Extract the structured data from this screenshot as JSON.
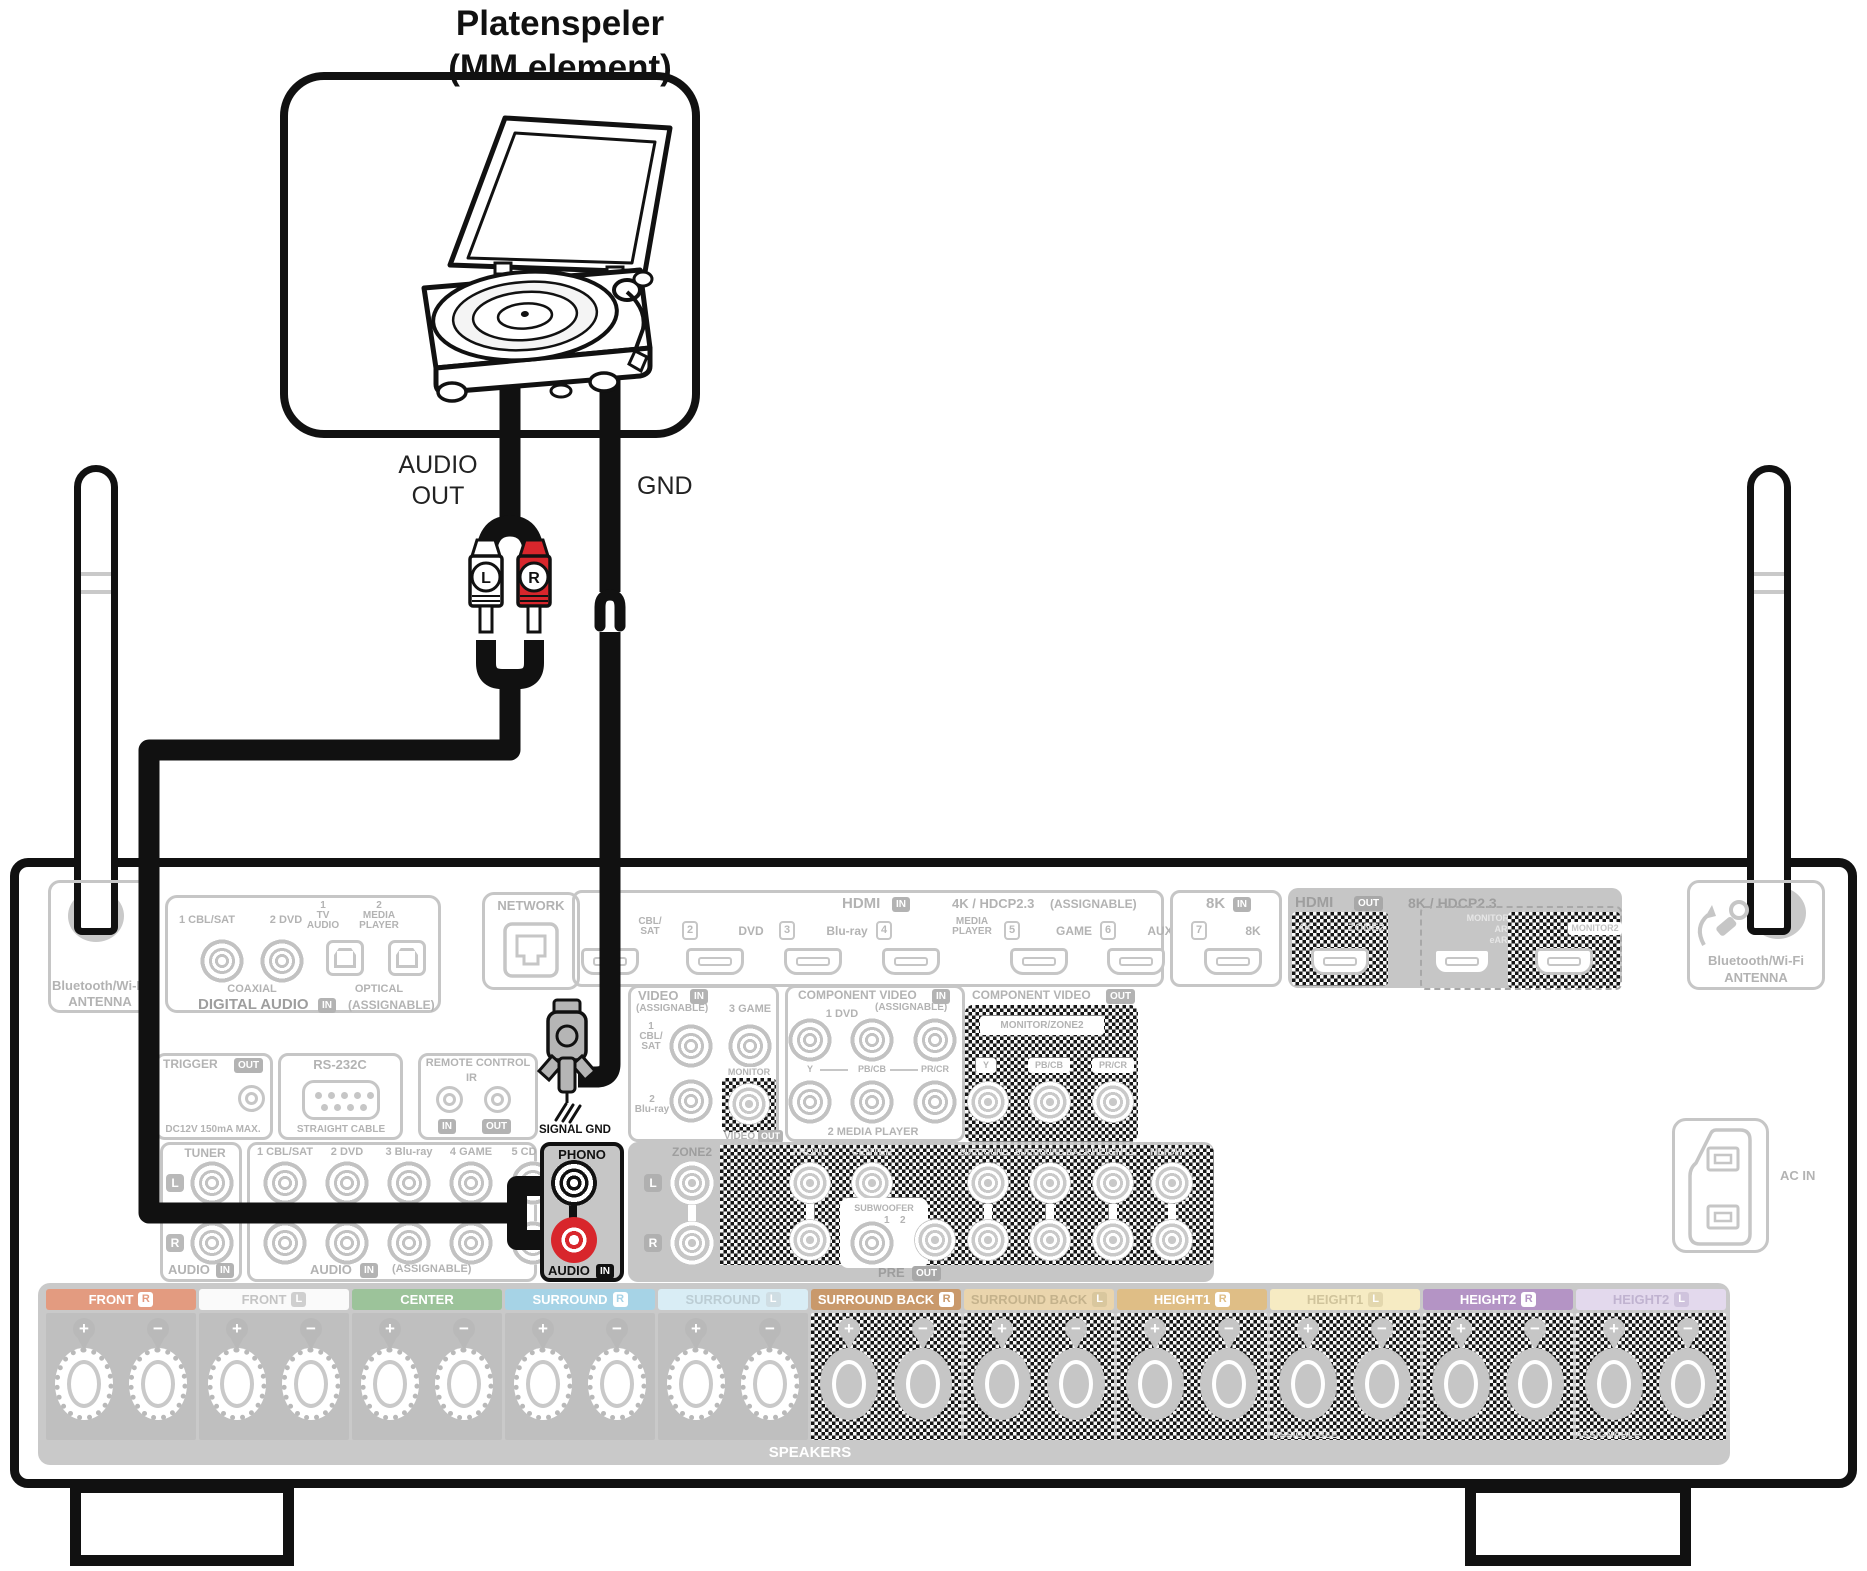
{
  "title": {
    "line1": "Platenspeler",
    "line2": "(MM element)"
  },
  "cables": {
    "audio_out": "AUDIO\nOUT",
    "gnd": "GND",
    "plug_l": "L",
    "plug_r": "R"
  },
  "colors": {
    "accent_red_plug": "#d8262c",
    "hatch_black": "#161616",
    "panel_gray": "#c6c6c6"
  },
  "panel": {
    "bt_left": {
      "line1": "Bluetooth/Wi-Fi",
      "line2": "ANTENNA"
    },
    "bt_right": {
      "line1": "Bluetooth/Wi-Fi",
      "line2": "ANTENNA"
    },
    "digital_audio": {
      "coax1": "1 CBL/SAT",
      "coax2": "2 DVD",
      "opt1": "1\nTV\nAUDIO",
      "opt2": "2\nMEDIA\nPLAYER",
      "coaxial": "COAXIAL",
      "optical": "OPTICAL",
      "title": "DIGITAL AUDIO",
      "badge_in": "IN",
      "assignable": "(ASSIGNABLE)"
    },
    "network": {
      "title": "NETWORK"
    },
    "hdmi_in": {
      "title": "HDMI",
      "badge_in": "IN",
      "spec": "4K / HDCP2.3",
      "assignable": "(ASSIGNABLE)",
      "p1": "CBL/\nSAT",
      "n2": "2",
      "p2": "DVD",
      "n3": "3",
      "p3": "Blu-ray",
      "n4": "4",
      "p4": "MEDIA\nPLAYER",
      "n5": "5",
      "p5": "GAME",
      "n6": "6",
      "p6": "AUX",
      "eightk_title": "8K",
      "eightk_badge": "IN",
      "n7": "7",
      "p7": "8K"
    },
    "hdmi_out": {
      "title": "HDMI",
      "badge_out": "OUT",
      "spec": "8K / HDCP2.3",
      "zone_4k": "4K",
      "zone2": "ZONE2",
      "monitor1": "MONITOR1\nARC\neARC",
      "monitor2": "MONITOR2"
    },
    "video_in": {
      "title": "VIDEO",
      "badge_in": "IN",
      "assignable": "(ASSIGNABLE)",
      "game": "3 GAME",
      "cblsat": "1\nCBL/\nSAT",
      "bluray": "2\nBlu-ray",
      "monitor": "MONITOR",
      "vout_title": "VIDEO",
      "vout_badge": "OUT"
    },
    "comp_in": {
      "title": "COMPONENT VIDEO",
      "badge_in": "IN",
      "assignable": "(ASSIGNABLE)",
      "dvd": "1 DVD",
      "y": "Y",
      "pb": "PB/CB",
      "pr": "PR/CR",
      "media": "2 MEDIA PLAYER"
    },
    "comp_out": {
      "title": "COMPONENT VIDEO",
      "badge_out": "OUT",
      "monitor": "MONITOR/ZONE2",
      "y": "Y",
      "pb": "PB/CB",
      "pr": "PR/CR"
    },
    "trigger": {
      "title": "TRIGGER",
      "badge_out": "OUT",
      "spec": "DC12V 150mA MAX."
    },
    "rs232": {
      "title": "RS-232C",
      "spec": "STRAIGHT CABLE"
    },
    "remote": {
      "title": "REMOTE CONTROL",
      "ir": "IR",
      "badge_in": "IN",
      "badge_out": "OUT"
    },
    "signal_gnd": "SIGNAL GND",
    "phono": {
      "title": "PHONO",
      "audio": "AUDIO",
      "badge_in": "IN"
    },
    "tuner": {
      "title": "TUNER",
      "l": "L",
      "r": "R",
      "audio": "AUDIO",
      "badge_in": "IN"
    },
    "analog": {
      "c1": "1 CBL/SAT",
      "c2": "2 DVD",
      "c3": "3 Blu-ray",
      "c4": "4 GAME",
      "c5": "5 CD",
      "audio": "AUDIO",
      "badge_in": "IN",
      "assignable": "(ASSIGNABLE)"
    },
    "pre_out": {
      "zone2": "ZONE2",
      "l": "L",
      "r": "R",
      "front": "FRONT",
      "center": "CENTER",
      "surround": "SURROUND",
      "surround_back": "SURROUND BACK",
      "height1": "HEIGHT1",
      "height2": "HEIGHT2",
      "subwoofer": "SUBWOOFER",
      "sub1": "1",
      "sub2": "2",
      "pre": "PRE",
      "badge_out": "OUT"
    },
    "ac_in": "AC IN"
  },
  "speakers": {
    "plus": "+",
    "minus": "−",
    "strip": "SPEAKERS",
    "assignable": "ASSIGNABLE",
    "sections": [
      {
        "label": "FRONT",
        "ch": "R"
      },
      {
        "label": "FRONT",
        "ch": "L"
      },
      {
        "label": "CENTER",
        "ch": ""
      },
      {
        "label": "SURROUND",
        "ch": "R"
      },
      {
        "label": "SURROUND",
        "ch": "L"
      },
      {
        "label": "SURROUND BACK",
        "ch": "R"
      },
      {
        "label": "SURROUND BACK",
        "ch": "L"
      },
      {
        "label": "HEIGHT1",
        "ch": "R"
      },
      {
        "label": "HEIGHT1",
        "ch": "L"
      },
      {
        "label": "HEIGHT2",
        "ch": "R"
      },
      {
        "label": "HEIGHT2",
        "ch": "L"
      }
    ]
  }
}
